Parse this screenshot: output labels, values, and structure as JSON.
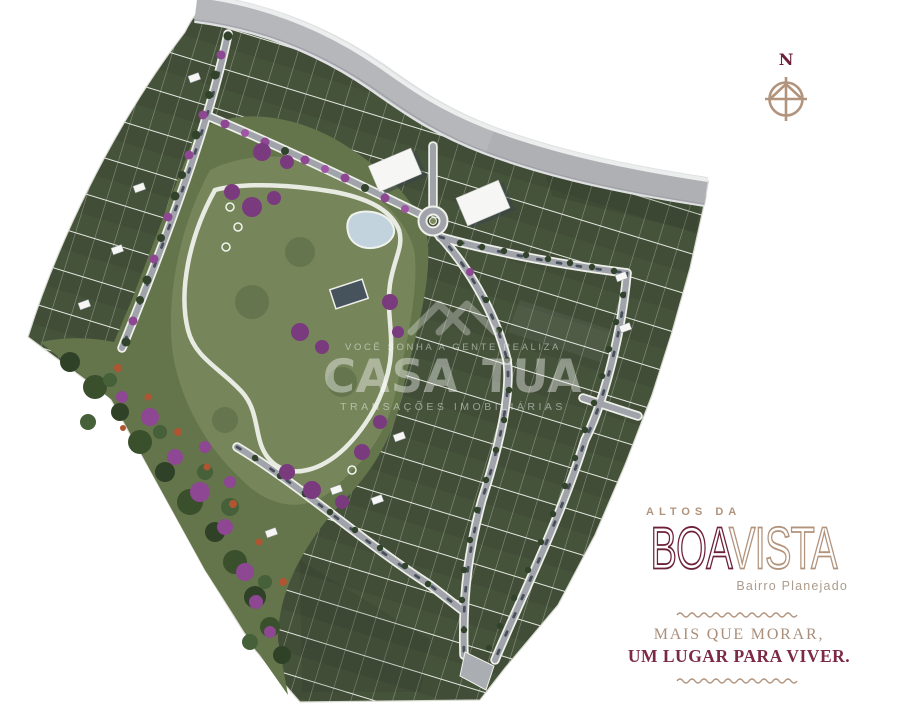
{
  "page": {
    "background": "#ffffff"
  },
  "map": {
    "kind": "aerial-masterplan",
    "colors": {
      "lot_green_dark": "#414d37",
      "lot_line_white": "#e9ece3",
      "park_lawn": "#76855a",
      "native_green": "#5b6c43",
      "road_gray": "#a0a4aa",
      "road_edge_white": "#eef0e9",
      "highway_gray": "#b5b7bb",
      "tree_green": "#31432a",
      "tree_purple": "#8e4792",
      "shrub_red": "#b05531",
      "water_blue": "#c3d3de",
      "building_white": "#f6f7f5"
    }
  },
  "compass": {
    "label": "N"
  },
  "watermark": {
    "tagline_top": "VOCÊ SONHA A GENTE REALIZA",
    "brand": "CASA TUA",
    "tagline_bottom": "TRANSAÇÕES IMOBILIÁRIAS",
    "color": "#ffffff"
  },
  "brand": {
    "kicker": "ALTOS DA",
    "logo_part1": "BOA",
    "logo_part2": "VISTA",
    "subtitle": "Bairro Planejado",
    "slogan_line1": "MAIS QUE MORAR,",
    "slogan_line2": "UM LUGAR PARA VIVER.",
    "colors": {
      "maroon": "#6d2038",
      "tan": "#b2937c",
      "subtitle_gray": "#ab9c8d"
    }
  }
}
